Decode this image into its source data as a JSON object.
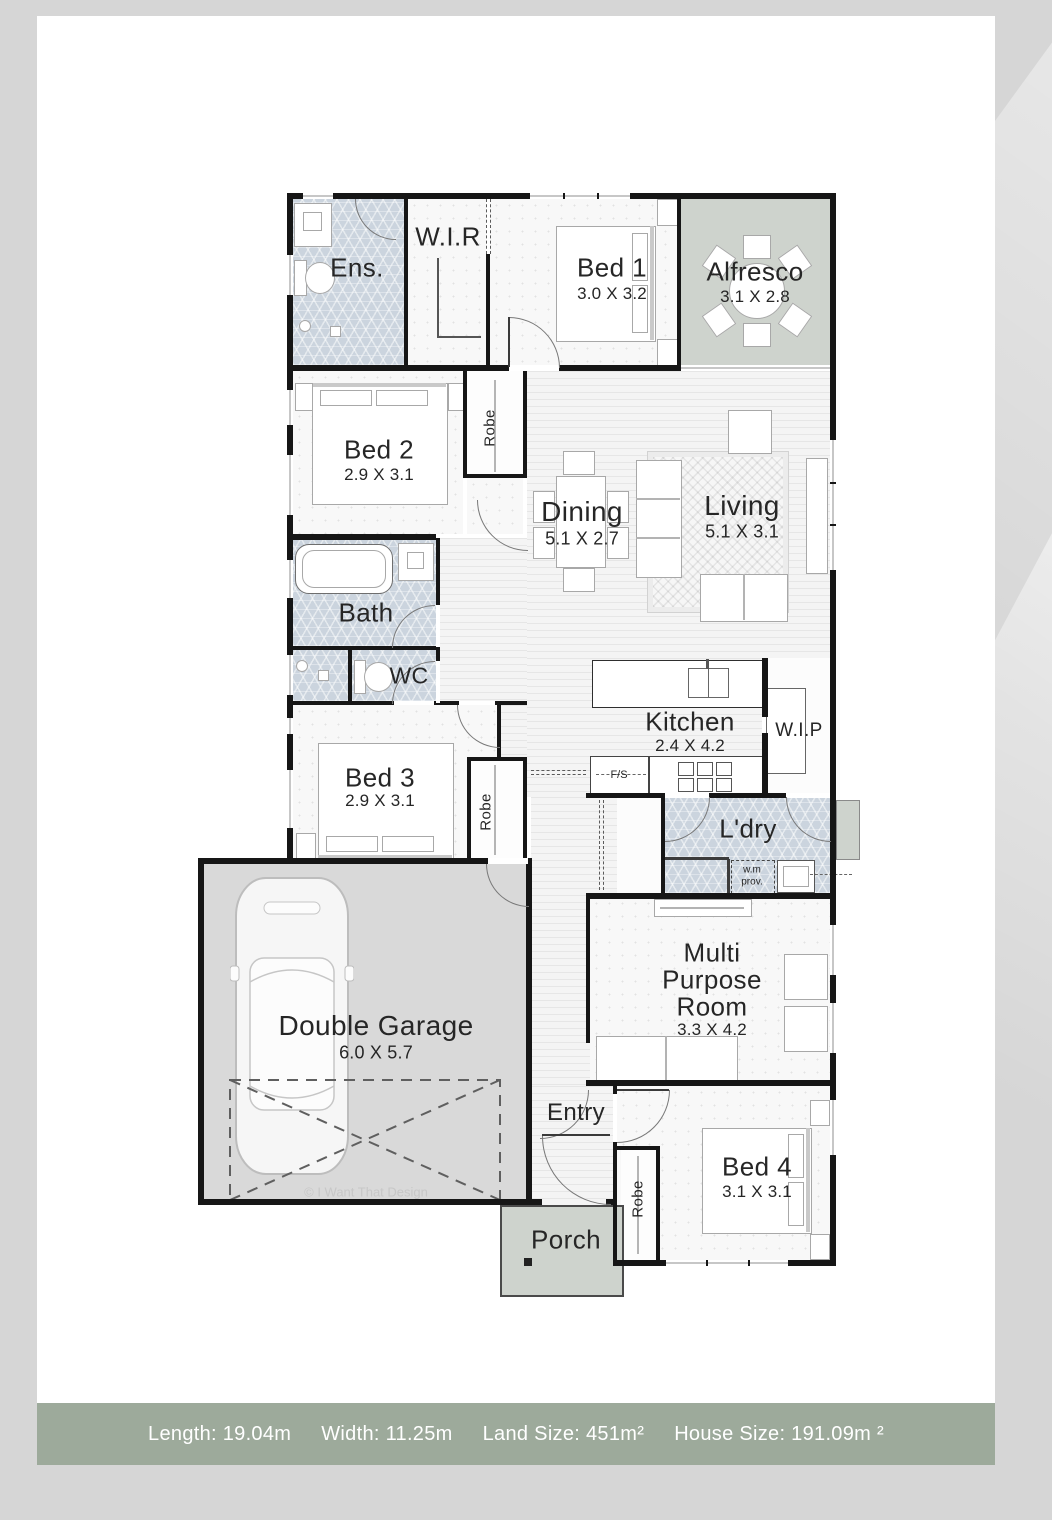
{
  "footer": {
    "items": [
      "Length: 19.04m",
      "Width: 11.25m",
      "Land Size: 451m²",
      "House Size: 191.09m ²"
    ]
  },
  "watermark": "© I Want That Design",
  "rooms": {
    "ens": {
      "name": "Ens."
    },
    "wir": {
      "name": "W.I.R"
    },
    "bed1": {
      "name": "Bed 1",
      "dims": "3.0 X 3.2"
    },
    "alfresco": {
      "name": "Alfresco",
      "dims": "3.1 X 2.8"
    },
    "bed2": {
      "name": "Bed 2",
      "dims": "2.9 X 3.1"
    },
    "robe_bed2": {
      "name": "Robe"
    },
    "dining": {
      "name": "Dining",
      "dims": "5.1 X 2.7"
    },
    "living": {
      "name": "Living",
      "dims": "5.1 X 3.1"
    },
    "bath": {
      "name": "Bath"
    },
    "wc": {
      "name": "WC"
    },
    "kitchen": {
      "name": "Kitchen",
      "dims": "2.4 X 4.2"
    },
    "wip": {
      "name": "W.I.P"
    },
    "fridge": {
      "name": "F/S"
    },
    "bed3": {
      "name": "Bed 3",
      "dims": "2.9 X 3.1"
    },
    "robe_bed3": {
      "name": "Robe"
    },
    "laundry": {
      "name": "L'dry"
    },
    "wm": {
      "line1": "w.m",
      "line2": "prov."
    },
    "garage": {
      "name": "Double Garage",
      "dims": "6.0 X 5.7"
    },
    "entry": {
      "name": "Entry"
    },
    "mpr": {
      "line1": "Multi",
      "line2": "Purpose",
      "line3": "Room",
      "dims": "3.3 X 4.2"
    },
    "bed4": {
      "name": "Bed 4",
      "dims": "3.1 X 3.1"
    },
    "robe_bed4": {
      "name": "Robe"
    },
    "porch": {
      "name": "Porch"
    }
  },
  "colors": {
    "background": "#d6d6d6",
    "panel": "#ffffff",
    "wall": "#161616",
    "wet_area_tile": "#cbd4de",
    "outdoor_sage": "#ced3cd",
    "garage_floor": "#d9d9d9",
    "footer_bar": "#9daa9b",
    "footer_text": "#ffffff"
  }
}
